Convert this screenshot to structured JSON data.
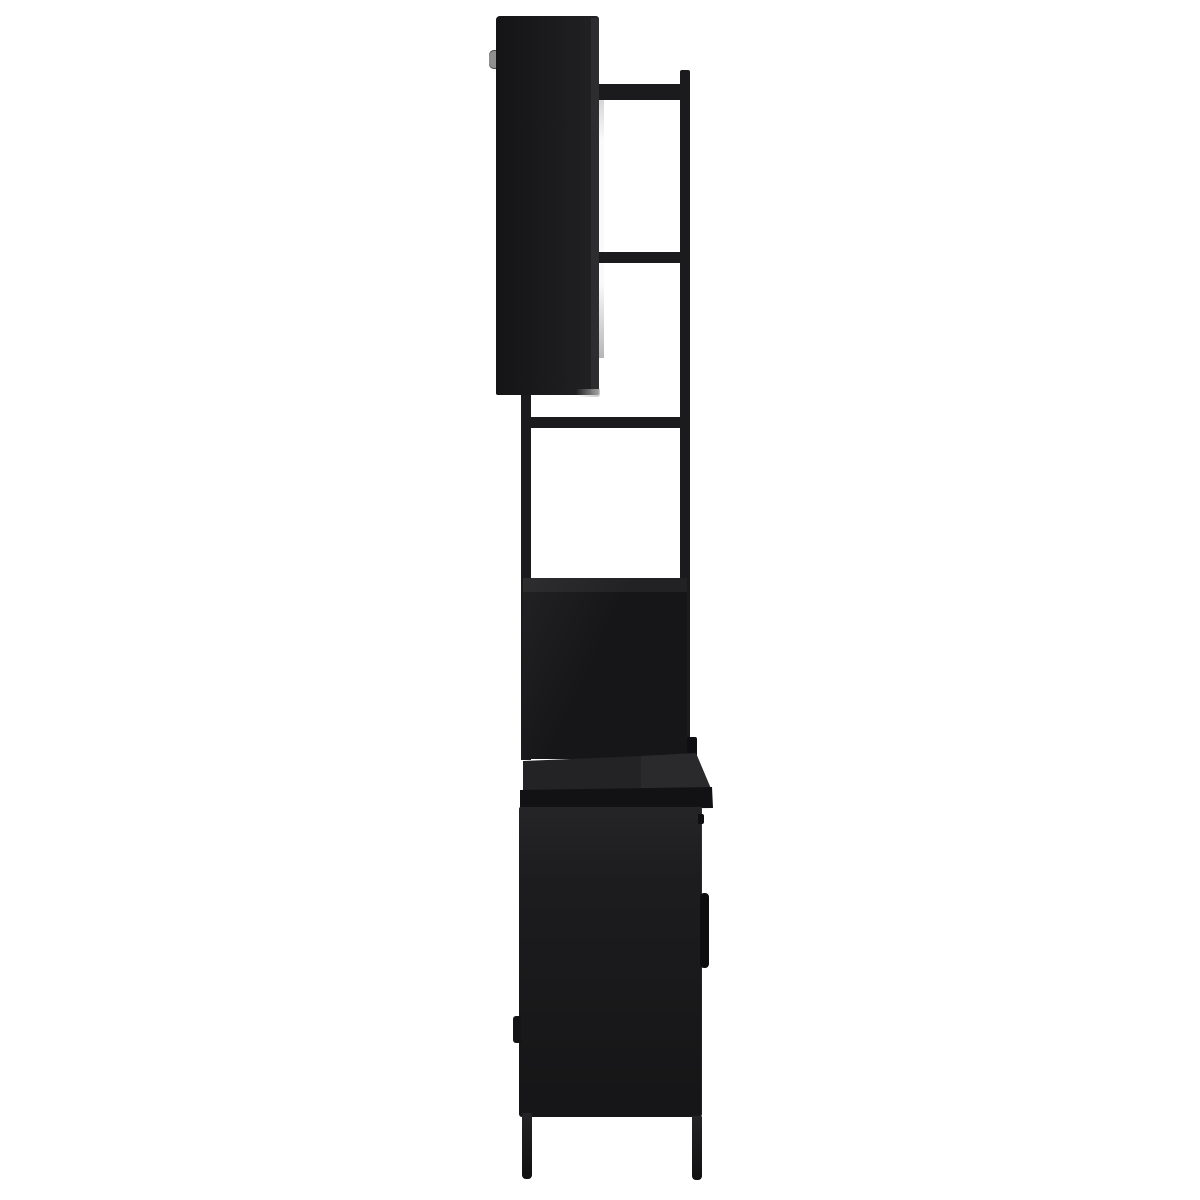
{
  "scene": {
    "kind": "product-photo",
    "subject": "Black 3-piece bathroom furniture set seen in straight side profile: wall-mounted mirror cabinet on top, open metal shelf frame in the middle, base cabinet with countertop, door handle and four legs at the bottom",
    "background": "#ffffff"
  },
  "palette": {
    "panel": "#1d1d1f",
    "panel_dark": "#161618",
    "panel_top_band": "#222224",
    "panel_edge": "#2d2d2f",
    "frame": "#1b1b1d",
    "counter_top": "#232325",
    "counter_top_light": "#2a2a2c",
    "counter_edge": "#121214",
    "cabinet_body": "#1c1c1e",
    "fitting_dark": "#0f0f11",
    "handle": "#0d0d0f",
    "hinge_lower": "#141416",
    "leg": "#18181a",
    "mirror_top": "#cfcfcf",
    "mirror_mid": "#fafafa",
    "mirror_bottom": "#b6b6b6",
    "hinge_metal": "#8f8f8f"
  },
  "parts": {
    "wall_cabinet": "side panel of mirror wall cabinet",
    "wall_cabinet_hinge": "metal hinge knob on front edge of wall cabinet",
    "mirror_strip": "edge-on sliver of mirror glass with light reflection",
    "frame_upright_right": "rear vertical frame post",
    "frame_upright_left": "front vertical frame post",
    "frame_bar_top": "upper shelf side bar",
    "frame_bar_middle": "middle shelf side bar",
    "frame_bar_lower": "lower shelf side bar",
    "middle_panel": "side panel between frame and countertop",
    "rear_mount_tab": "rear mounting tab",
    "countertop": "countertop seen from the side with beveled right end",
    "base_cabinet": "base cabinet body side panel",
    "door_handle": "vertical door handle on right side",
    "base_cabinet_hinge": "door hinge on front edge of base cabinet",
    "legs": "two tapered black metal legs visible in profile"
  }
}
